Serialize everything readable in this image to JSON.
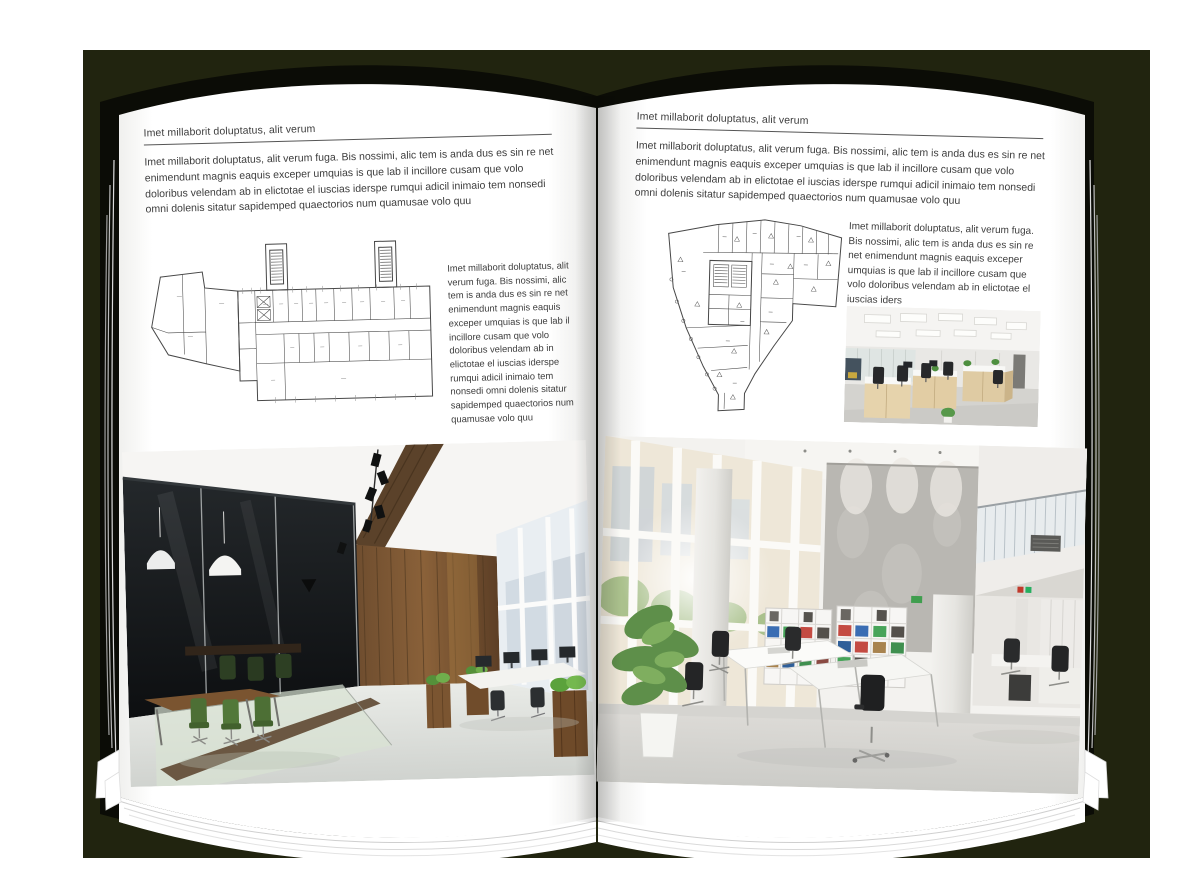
{
  "canvas": {
    "background": "#ffffff",
    "backdrop_color": "#21240f",
    "cover_color": "#0b0c06",
    "page_color": "#ffffff"
  },
  "left_page": {
    "header": "Imet millaborit doluptatus, alit verum",
    "intro": "Imet millaborit doluptatus, alit verum fuga. Bis nossimi, alic tem is anda dus es sin re net enimendunt magnis eaquis exceper umquias is que lab il incillore cusam que volo doloribus velendam ab in elictotae el iuscias iderspe rumqui adicil inimaio tem nonsedi omni dolenis sitatur sapidemped quaectorios num quamusae volo quu",
    "side_text": "Imet millaborit doluptatus, alit verum fuga. Bis nossimi, alic tem is anda dus es sin re net enimendunt magnis eaquis exceper umquias is que lab il incillore cusam que volo doloribus velendam ab in elictotae el iuscias iderspe rumqui adicil inimaio tem nonsedi omni dolenis sitatur sapidemped quaectorios num quamusae volo quu",
    "floor_plan_label": "architectural-floor-plan-wing-building",
    "photo_label": "dark-wood-loft-office-photo"
  },
  "right_page": {
    "header": "Imet millaborit doluptatus, alit verum",
    "intro": "Imet millaborit doluptatus, alit verum fuga. Bis nossimi, alic tem is anda dus es sin re net enimendunt magnis eaquis exceper umquias is que lab il incillore cusam que volo doloribus velendam ab in elictotae el iuscias iderspe rumqui adicil inimaio tem nonsedi omni dolenis sitatur sapidemped quaectorios num quamusae volo quu",
    "side_text": "Imet millaborit doluptatus, alit verum fuga. Bis nossimi, alic tem is anda dus es sin re net enimendunt magnis eaquis exceper umquias is que lab il incillore cusam que volo doloribus velendam ab in elictotae el iuscias iders",
    "floor_plan_label": "architectural-floor-plan-wedge-building",
    "small_photo_label": "open-plan-workstations-photo",
    "photo_label": "white-atrium-office-photo"
  }
}
